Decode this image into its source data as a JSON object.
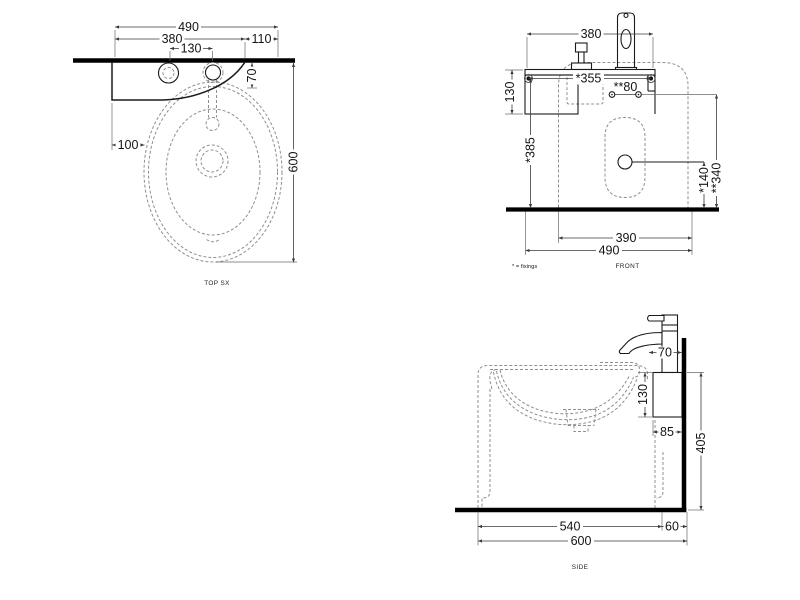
{
  "drawing": {
    "views": {
      "top": {
        "label": "TOP SX",
        "dim_overall_width": "490",
        "dim_shelf_width": "380",
        "dim_right_offset": "110",
        "dim_hole_spacing": "130",
        "dim_wall_offset": "70",
        "dim_left_offset": "100",
        "dim_overall_depth": "600"
      },
      "front": {
        "label": "FRONT",
        "note": "* = fixings",
        "dim_tap_width": "380",
        "dim_fixings_spacing": "*355",
        "dim_holes_spacing": "**80",
        "dim_bracket_height": "130",
        "dim_fixings_height": "*385",
        "dim_drain_height": "*140",
        "dim_holes_height": "**340",
        "dim_basin_width": "390",
        "dim_overall_width": "490"
      },
      "side": {
        "label": "SIDE",
        "dim_tap_offset": "70",
        "dim_bracket_height": "130",
        "dim_bracket_depth": "85",
        "dim_bracket_floor": "405",
        "dim_basin_depth": "540",
        "dim_wall_gap": "60",
        "dim_overall_depth": "600"
      }
    }
  }
}
